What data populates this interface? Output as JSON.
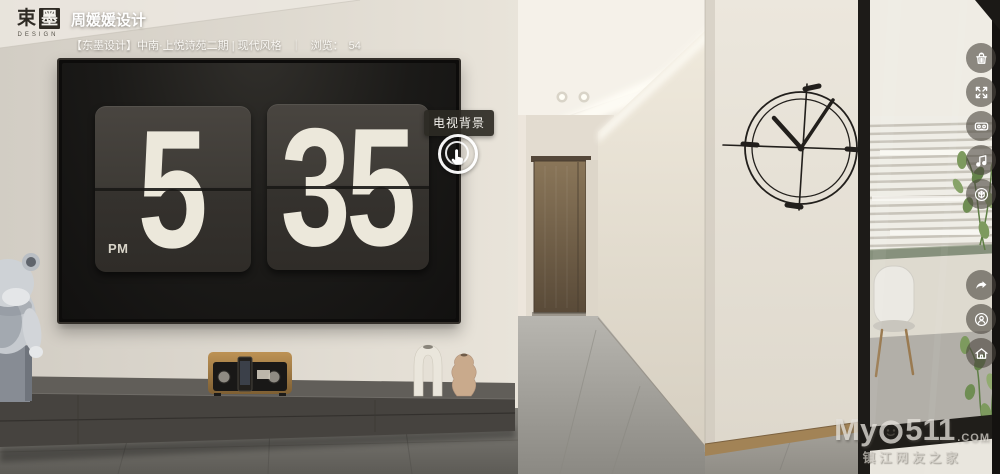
{
  "header": {
    "logo": {
      "char1": "束",
      "char2": "墨",
      "sub": "DESIGN"
    },
    "title": "周媛媛设计",
    "subtitle": "【东墨设计】中南·上悦诗苑二期 | 现代风格",
    "sep": "｜",
    "views_label": "浏览：",
    "views_count": "54"
  },
  "clock": {
    "hour": "5",
    "minute": "35",
    "meridiem": "PM"
  },
  "hotspot": {
    "label": "电视背景"
  },
  "toolbar": {
    "icons": [
      "trash-icon",
      "fullscreen-icon",
      "vr-goggles-icon",
      "music-note-icon",
      "gyroscope-icon",
      "share-icon",
      "contact-icon",
      "home-icon"
    ]
  },
  "watermark": {
    "prefix": "My",
    "digits": "511",
    "suffix": ".COM",
    "tagline": "镇江网友之家"
  },
  "colors": {
    "wall": "#e2ddd3",
    "tv_screen": "#171614",
    "flip_card": "#3d3a35",
    "digits": "#ece8db",
    "console": "#4a4743",
    "door": "#7c6950",
    "toolbar_bg": "rgba(78,73,64,0.62)",
    "tooltip_bg": "rgba(45,42,36,0.92)"
  }
}
